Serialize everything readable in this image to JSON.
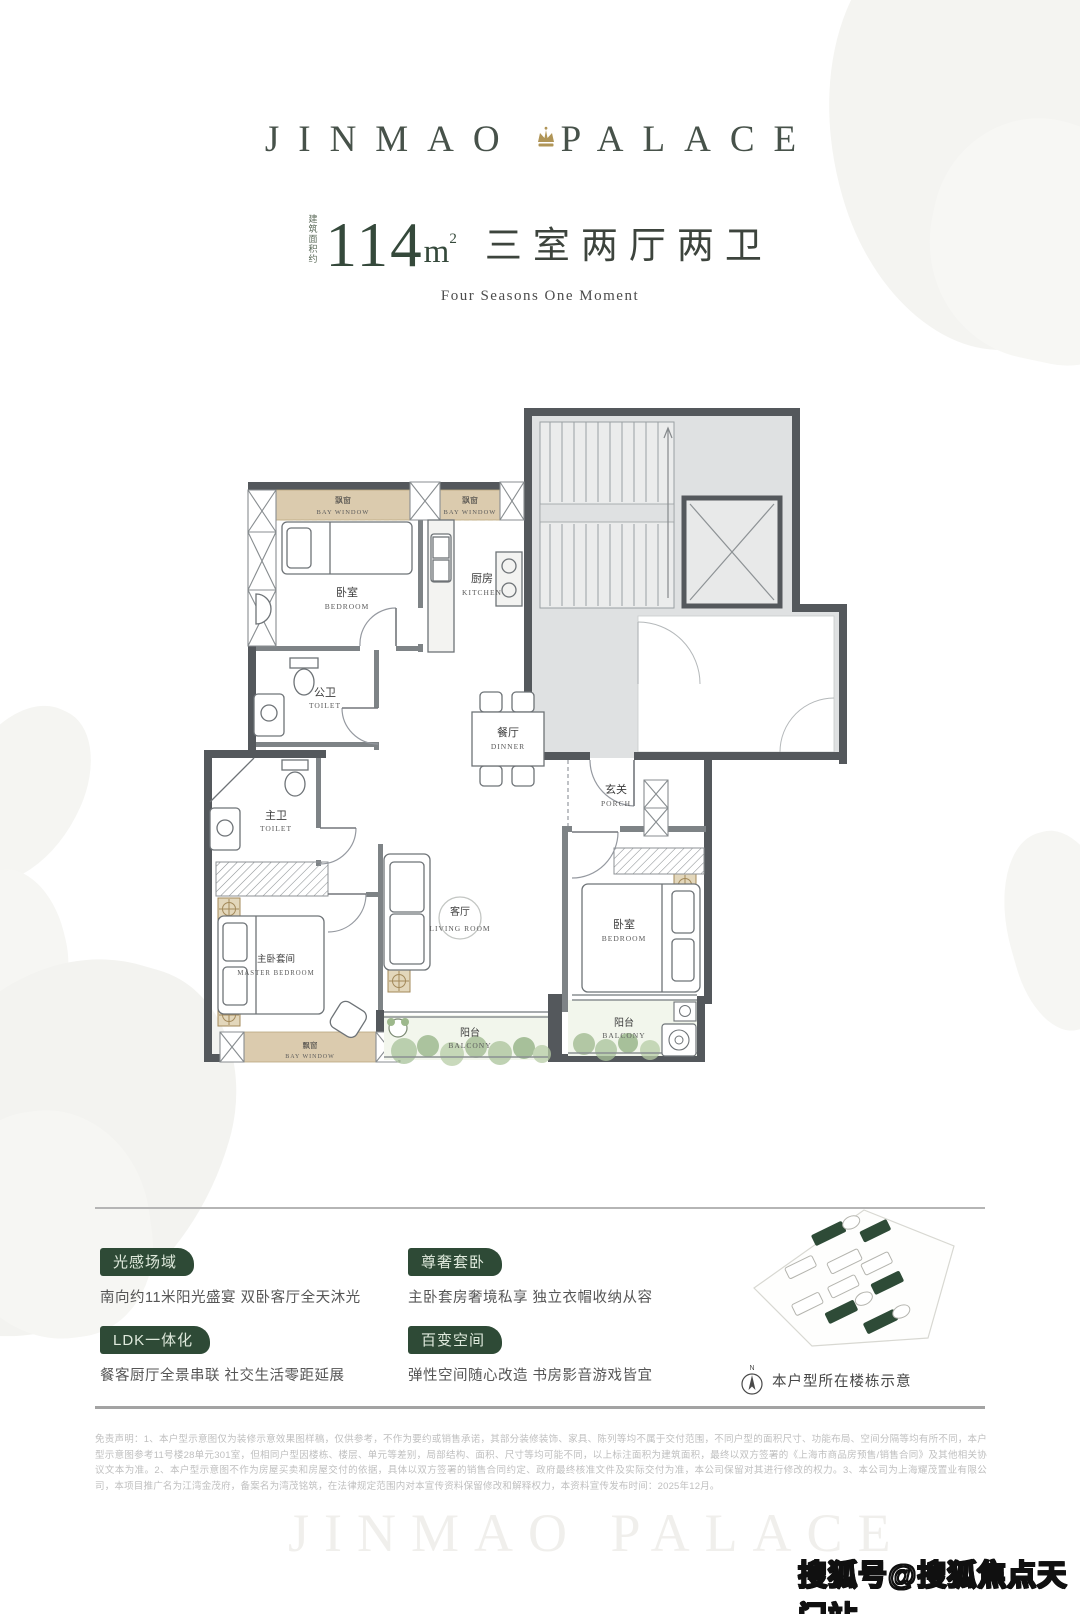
{
  "logo": {
    "left": "JINMAO",
    "right": "PALACE"
  },
  "title": {
    "area_note": "建筑面积约",
    "area_number": "114",
    "area_unit": "m",
    "area_power": "2",
    "rooms": "三室两厅两卫",
    "subtitle": "Four Seasons One Moment"
  },
  "floorplan": {
    "rooms": {
      "bay_nw": {
        "cn": "飘窗",
        "en": "BAY WINDOW"
      },
      "bay_n": {
        "cn": "飘窗",
        "en": "BAY WINDOW"
      },
      "bedroom_n": {
        "cn": "卧室",
        "en": "BEDROOM"
      },
      "kitchen": {
        "cn": "厨房",
        "en": "KITCHEN"
      },
      "wc_public": {
        "cn": "公卫",
        "en": "TOILET"
      },
      "dining": {
        "cn": "餐厅",
        "en": "DINNER"
      },
      "porch": {
        "cn": "玄关",
        "en": "PORCH"
      },
      "wc_master": {
        "cn": "主卫",
        "en": "TOILET"
      },
      "living": {
        "cn": "客厅",
        "en": "LIVING ROOM"
      },
      "master": {
        "cn": "主卧套间",
        "en": "MASTER BEDROOM"
      },
      "bedroom_s": {
        "cn": "卧室",
        "en": "BEDROOM"
      },
      "balcony_c": {
        "cn": "阳台",
        "en": "BALCONY"
      },
      "balcony_e": {
        "cn": "阳台",
        "en": "BALCONY"
      },
      "bay_s": {
        "cn": "飘窗",
        "en": "BAY WINDOW"
      }
    }
  },
  "features": [
    {
      "tag": "光感场域",
      "desc": "南向约11米阳光盛宴 双卧客厅全天沐光"
    },
    {
      "tag": "尊奢套卧",
      "desc": "主卧套房奢境私享 独立衣帽收纳从容"
    },
    {
      "tag": "LDK一体化",
      "desc": "餐客厨厅全景串联 社交生活零距延展"
    },
    {
      "tag": "百变空间",
      "desc": "弹性空间随心改造 书房影音游戏皆宜"
    }
  ],
  "siteplan": {
    "compass": "N",
    "caption": "本户型所在楼栋示意"
  },
  "disclaimer": "免责声明：1、本户型示意图仅为装修示意效果图样稿，仅供参考，不作为要约或销售承诺，其部分装修装饰、家具、陈列等均不属于交付范围，不同户型的面积尺寸、功能布局、空间分隔等均有所不同，本户型示意图参考11号楼28单元301室，但相同户型因楼栋、楼层、单元等差别，局部结构、面积、尺寸等均可能不同，以上标注面积为建筑面积，最终以双方签署的《上海市商品房预售/销售合同》及其他相关协议文本为准。2、本户型示意图不作为房屋买卖和房屋交付的依据，具体以双方签署的销售合同约定、政府最终核准文件及实际交付为准，本公司保留对其进行修改的权力。3、本公司为上海耀茂置业有限公司，本项目推广名为江湾金茂府，备案名为湾茂铭筑，在法律规定范围内对本宣传资料保留修改和解释权力，本资料宣传发布时间：2025年12月。",
  "watermarks": {
    "brand": "JINMAO PALACE",
    "sohu": "搜狐号@搜狐焦点天门站"
  },
  "colors": {
    "brand_green": "#2e4a36",
    "gold": "#a3895a",
    "wall_dark": "#54585c",
    "bay_tan": "#dbcbae",
    "core_gray": "#dfe1e2"
  }
}
